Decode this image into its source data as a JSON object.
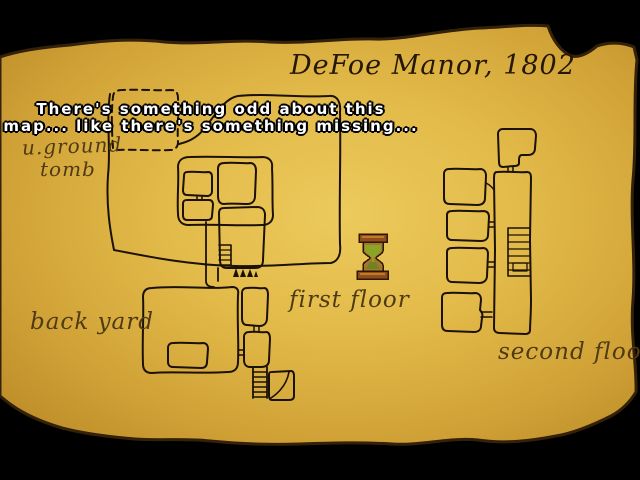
{
  "window": {
    "width": 640,
    "height": 480,
    "background": "#000000"
  },
  "map": {
    "title": "DeFoe Manor, 1802",
    "labels": {
      "underground_tomb_line1": "u.ground",
      "underground_tomb_line2": "tomb",
      "back_yard": "back yard",
      "first_floor": "first floor",
      "second_floor": "second floor"
    },
    "colors": {
      "parchment_center": "#eac657",
      "parchment_mid": "#d9ae3f",
      "parchment_edge": "#bd8c28",
      "parchment_shadow_edge": "#33210a",
      "ink": "#1c1106",
      "label_ink": "#4f3a14",
      "title_ink": "#241704"
    }
  },
  "speech": {
    "line1": "There's something odd about this",
    "line2": "map... like there's something missing...",
    "text_color": "#ffffff",
    "outline_color": "#000000"
  },
  "cursor": {
    "icon": "hourglass-wait-icon",
    "frame_color": "#8e4d1a",
    "frame_highlight": "#c07a28",
    "sand_color": "#8aa426",
    "outline_color": "#2e1605"
  }
}
